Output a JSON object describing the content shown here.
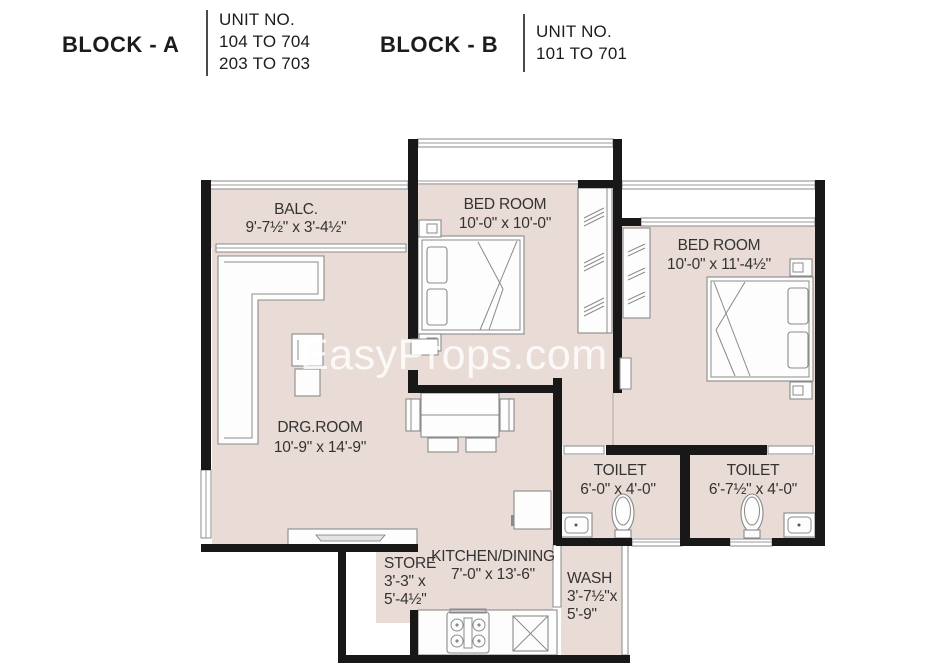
{
  "header": {
    "blocks": [
      {
        "name": "BLOCK - A",
        "unit_label": "UNIT NO.",
        "units": [
          "104 TO 704",
          "203 TO 703"
        ]
      },
      {
        "name": "BLOCK - B",
        "unit_label": "UNIT NO.",
        "units": [
          "101 TO 701"
        ]
      }
    ]
  },
  "watermark": "EasyProps.com",
  "rooms": {
    "balcony": {
      "name": "BALC.",
      "dim": "9'-7½\" x 3'-4½\""
    },
    "bedroom1": {
      "name": "BED ROOM",
      "dim": "10'-0\" x 10'-0\""
    },
    "bedroom2": {
      "name": "BED ROOM",
      "dim": "10'-0\" x 11'-4½\""
    },
    "drawing_room": {
      "name": "DRG.ROOM",
      "dim": "10'-9\" x 14'-9\""
    },
    "toilet1": {
      "name": "TOILET",
      "dim": "6'-0\" x 4'-0\""
    },
    "toilet2": {
      "name": "TOILET",
      "dim": "6'-7½\" x 4'-0\""
    },
    "store": {
      "name": "STORE",
      "dim_line1": "3'-3\" x",
      "dim_line2": "5'-4½\""
    },
    "kitchen": {
      "name": "KITCHEN/DINING",
      "dim": "7'-0\" x 13'-6\""
    },
    "wash": {
      "name": "WASH",
      "dim_line1": "3'-7½\"x",
      "dim_line2": "5'-9\""
    }
  },
  "colors": {
    "wall": "#181818",
    "floor": "#e9dbd5",
    "furniture_stroke": "#8a8a8a"
  }
}
